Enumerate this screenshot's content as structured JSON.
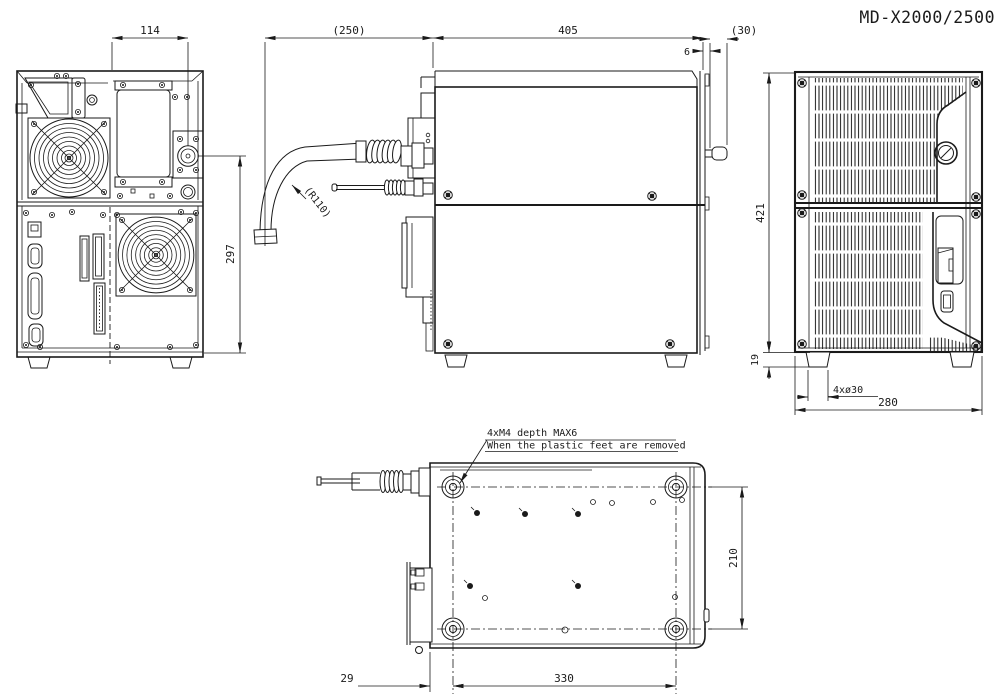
{
  "title": "MD-X2000/2500",
  "colors": {
    "ink": "#1a1a1a",
    "paper": "#ffffff"
  },
  "views": {
    "rear": {
      "label": "rear-view",
      "dim_panel_width": "114",
      "dim_height_to_connector": "297"
    },
    "side": {
      "label": "side-view",
      "dim_cable_clearance": "(250)",
      "dim_depth": "405",
      "dim_bezel": "6",
      "dim_knob": "(30)",
      "dim_bend_radius": "(R110)"
    },
    "front": {
      "label": "front-view",
      "dim_height": "421",
      "dim_foot_height": "19",
      "dim_feet_diameter": "4xø30",
      "dim_width": "280"
    },
    "bottom": {
      "label": "bottom-view",
      "dim_feet_pitch_depth": "210",
      "dim_feet_pitch_width": "330",
      "dim_foot_offset": "29",
      "note_line1": "4xM4 depth MAX6",
      "note_line2": "When the plastic feet are removed"
    }
  }
}
